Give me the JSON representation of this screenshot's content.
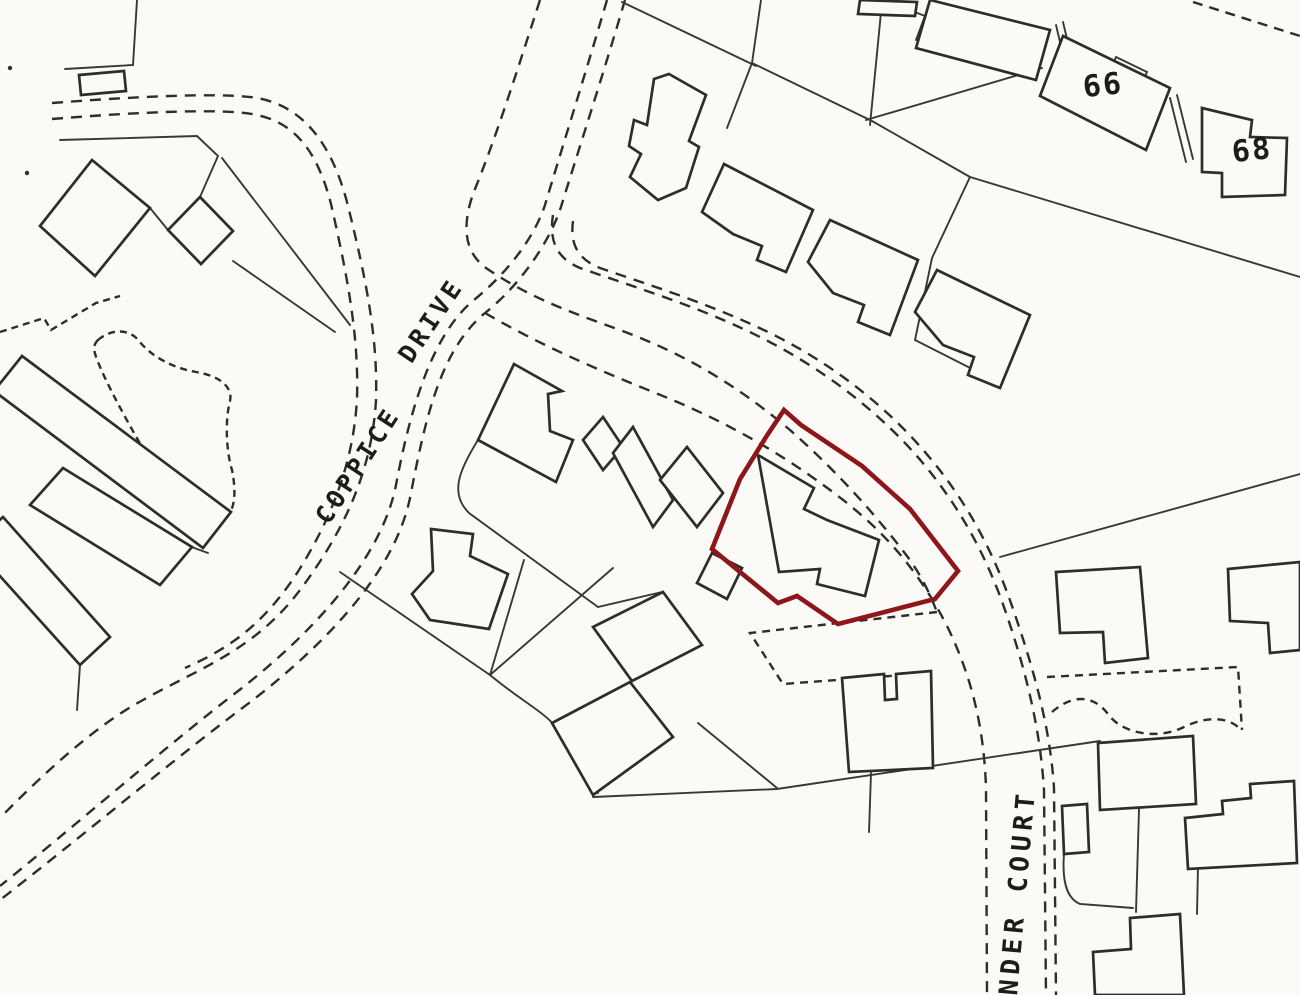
{
  "colors": {
    "paper": "#fbfaf7",
    "ink": "#2e2d29",
    "plot_ink": "#3a3833",
    "boundary_red": "#8d161a"
  },
  "map": {
    "labels": [
      {
        "text": "COPPICE",
        "x": 365,
        "y": 470,
        "rotate": -57,
        "size": 25,
        "spacing": 4
      },
      {
        "text": "DRIVE",
        "x": 438,
        "y": 325,
        "rotate": -56,
        "size": 25,
        "spacing": 4
      },
      {
        "text": "NDER COURT",
        "x": 1026,
        "y": 893,
        "rotate": -85,
        "size": 26,
        "spacing": 5
      },
      {
        "text": "66",
        "x": 1104,
        "y": 95,
        "rotate": -6,
        "size": 30,
        "spacing": 2
      },
      {
        "text": "68",
        "x": 1253,
        "y": 160,
        "rotate": -6,
        "size": 30,
        "spacing": 2
      }
    ],
    "red_boundary": {
      "name": "site-boundary",
      "points": "784,410 801,425 862,466 910,509 958,571 935,599 838,624 797,596 778,603 712,549 740,479 766,437",
      "color": "#8d161a",
      "width": 4.6
    },
    "buildings": [
      {
        "name": "outbuilding-top-left",
        "points": "79,75 124,71 126,91 81,95"
      },
      {
        "name": "house-pair-northwest",
        "points": "92,160 150,208 95,276 40,226"
      },
      {
        "name": "shed-diamond",
        "points": "200,197 233,231 201,264 168,230"
      },
      {
        "name": "terrace-west-a",
        "points": "22,356 231,512 203,548 -6,391"
      },
      {
        "name": "terrace-west-b",
        "points": "63,468 192,547 160,585 30,505"
      },
      {
        "name": "terrace-west-c",
        "points": "3,517 110,637 80,665 -28,545"
      },
      {
        "name": "house-coppice-east",
        "points": "514,364 562,391 548,394 550,431 573,440 556,482 478,440"
      },
      {
        "name": "house-middle-a",
        "points": "603,417 583,440 603,470 623,447"
      },
      {
        "name": "house-middle-b",
        "points": "633,427 613,453 653,527 673,500"
      },
      {
        "name": "house-middle-c",
        "points": "687,447 660,480 697,527 723,493"
      },
      {
        "name": "house-southwest",
        "points": "431,529 473,534 470,556 508,574 489,629 430,620 412,594 433,571"
      },
      {
        "name": "house-inside-site",
        "points": "758,455 814,488 804,509 827,520 879,540 865,596 817,584 820,569 779,572"
      },
      {
        "name": "garage-inside-site",
        "points": "712,553 742,568 727,599 697,583"
      },
      {
        "name": "square-house-north",
        "points": "593,627 663,592 702,645 632,681"
      },
      {
        "name": "square-house-south",
        "points": "552,723 630,682 673,737 593,795"
      },
      {
        "name": "house-top-row-1",
        "points": "669,74 706,95 689,141 699,147 686,188 658,200 630,177 641,154 629,146 634,120 647,125 654,79"
      },
      {
        "name": "house-top-row-2",
        "points": "724,164 813,210 786,272 757,260 762,246 733,234 702,212"
      },
      {
        "name": "house-top-row-3",
        "points": "830,220 918,260 890,335 858,322 864,305 833,293 808,262"
      },
      {
        "name": "house-top-row-4",
        "points": "937,270 1030,315 1000,388 968,375 974,357 943,345 915,312"
      },
      {
        "name": "house-66",
        "points": "1063,36 1170,88 1146,150 1040,96"
      },
      {
        "name": "house-68",
        "points": "1202,108 1252,120 1250,137 1287,138 1285,195 1222,197 1222,173 1202,172"
      },
      {
        "name": "house-top-edge-a",
        "points": "860,0 917,2 915,16 858,14"
      },
      {
        "name": "house-top-edge-b",
        "points": "930,0 1050,30 1036,80 916,48"
      },
      {
        "name": "house-east-l-shape",
        "points": "1056,572 1140,567 1148,658 1105,663 1103,632 1060,633"
      },
      {
        "name": "house-east-partial",
        "points": "1228,569 1300,562 1300,650 1270,653 1268,623 1230,621"
      },
      {
        "name": "house-court-l-shape",
        "points": "842,678 884,674 885,700 897,699 896,674 908,673 931,671 933,768 849,772"
      },
      {
        "name": "house-court-block",
        "points": "1098,743 1193,736 1196,804 1100,810"
      },
      {
        "name": "outbuilding-court",
        "points": "1062,806 1087,804 1089,852 1064,854"
      },
      {
        "name": "house-court-stepped",
        "points": "1185,818 1223,814 1222,801 1251,798 1250,784 1294,781 1297,863 1188,869"
      },
      {
        "name": "house-bottom-partial",
        "points": "1093,952 1131,949 1130,918 1180,914 1184,995 1095,995"
      }
    ],
    "plot_lines": [
      {
        "name": "wall-top-left",
        "d": "M137,0 L133,65 L65,69"
      },
      {
        "name": "fence-top-left",
        "d": "M60,140 L197,136 L218,156 L200,197"
      },
      {
        "name": "fence-link-shed",
        "d": "M168,230 L150,208"
      },
      {
        "name": "fence-to-road-a",
        "d": "M222,158 L350,325"
      },
      {
        "name": "fence-to-road-b",
        "d": "M233,261 L335,332"
      },
      {
        "name": "party-wall-nw",
        "d": "M117,186 L63,247"
      },
      {
        "name": "fence-top-center-a",
        "d": "M622,2 L756,66"
      },
      {
        "name": "fence-top-center-b",
        "d": "M761,0 L752,63"
      },
      {
        "name": "fence-top-center-c",
        "d": "M752,63 L727,128"
      },
      {
        "name": "fence-top-center-d",
        "d": "M752,63 L872,121 L970,177"
      },
      {
        "name": "fence-top-right-long",
        "d": "M970,177 L1300,277"
      },
      {
        "name": "fence-top-right-zig",
        "d": "M970,177 L932,258 L915,340 L980,373 L1020,330"
      },
      {
        "name": "fence-vertical-top",
        "d": "M882,2 L870,125"
      },
      {
        "name": "fence-to-66",
        "d": "M866,120 L1042,68"
      },
      {
        "name": "field-line-east",
        "d": "M1000,557 L1300,474"
      },
      {
        "name": "fence-mid-a",
        "d": "M340,572 L490,675"
      },
      {
        "name": "fence-mid-b",
        "d": "M524,560 L490,675"
      },
      {
        "name": "fence-mid-curve",
        "d": "M490,675 C520,700 543,711 557,728 C575,749 590,772 598,793"
      },
      {
        "name": "fence-mid-c",
        "d": "M490,675 L613,568"
      },
      {
        "name": "garden-corner-curve",
        "d": "M478,440 C458,472 450,494 469,513 L598,607"
      },
      {
        "name": "fence-mid-d",
        "d": "M598,607 L662,592"
      },
      {
        "name": "fence-bottom-long",
        "d": "M593,797 L777,789 L1100,741"
      },
      {
        "name": "fence-bottom-e",
        "d": "M698,723 L777,788"
      },
      {
        "name": "fence-court-vert-a",
        "d": "M1141,741 L1136,912"
      },
      {
        "name": "fence-court-vert-b",
        "d": "M871,773 L869,832"
      },
      {
        "name": "fence-court-vert-c",
        "d": "M1198,866 L1197,914"
      },
      {
        "name": "terrace-tail",
        "d": "M77,710 L80,665"
      },
      {
        "name": "terrace-notch",
        "d": "M186,545 L208,553"
      },
      {
        "name": "party-wall-66-a",
        "d": "M1056,25 L1072,93"
      },
      {
        "name": "party-wall-66-b",
        "d": "M1063,22 L1079,90"
      },
      {
        "name": "party-wall-68-a",
        "d": "M1170,98 L1186,162"
      },
      {
        "name": "party-wall-68-b",
        "d": "M1177,95 L1193,159"
      },
      {
        "name": "corner-top-right",
        "d": "M884,0 L925,16 L916,40"
      },
      {
        "name": "porch-66",
        "d": "M1116,57 L1147,72 L1142,84 L1111,69 Z"
      },
      {
        "name": "party-wall-court",
        "d": "M1145,739 L1148,806"
      },
      {
        "name": "garden-round-court",
        "d": "M1064,854 C1062,880 1066,898 1080,904 L1133,908"
      }
    ],
    "dashed_paths": [
      {
        "name": "road-coppice-west-outer",
        "dash": "11 8",
        "d": "M52,103 C155,95 228,93 257,98 C302,106 331,142 347,202 C366,278 378,338 376,400 C372,470 345,530 300,590 C255,650 200,668 143,700 C95,726 45,772 0,818"
      },
      {
        "name": "road-coppice-west-inner",
        "dash": "11 8",
        "d": "M52,119 C150,111 224,109 252,114 C294,121 317,150 331,204 C347,274 359,336 357,398 C354,458 334,514 299,570 C262,628 225,650 185,668"
      },
      {
        "name": "road-coppice-east-a",
        "dash": "11 8",
        "d": "M625,0 C602,78 578,152 560,210 C548,244 520,285 485,313 C440,350 425,420 410,498 C395,570 330,640 253,700 C175,758 80,838 0,900"
      },
      {
        "name": "road-coppice-east-b",
        "dash": "11 8",
        "d": "M607,0 C585,75 562,148 545,205 C534,238 508,272 474,300 C432,334 410,410 396,485 C382,556 318,628 242,688 C166,746 75,826 0,886"
      },
      {
        "name": "road-court-north-a",
        "dash": "11 8",
        "d": "M553,215 C549,240 556,258 580,268 C640,289 700,307 760,337 C820,367 878,410 922,462 C958,505 985,552 1005,610 C1025,668 1040,726 1044,790 L1046,995"
      },
      {
        "name": "road-court-north-b",
        "dash": "11 8",
        "d": "M573,221 C570,243 577,259 600,268 C658,288 716,306 774,335 C832,364 888,407 930,458 C965,500 992,548 1012,606 C1032,664 1050,724 1054,788 L1056,995"
      },
      {
        "name": "road-court-south",
        "dash": "11 8",
        "d": "M485,313 C540,345 598,370 658,394 C718,418 778,450 838,496 C888,534 922,576 948,628 C972,678 984,728 986,788 L987,995"
      },
      {
        "name": "site-verge-dashed",
        "dash": "11 8",
        "d": "M540,0 C518,68 496,138 473,194 C462,226 464,252 486,268 C530,298 570,312 620,330 C690,356 740,388 790,430 C840,474 880,520 910,560 C925,582 930,595 937,612"
      },
      {
        "name": "garden-quad-dashed",
        "dash": "8 6",
        "d": "M937,612 L750,633 L783,684 L930,673"
      },
      {
        "name": "plot-dashed-court-a",
        "dash": "8 6",
        "d": "M1047,677 L1238,667 L1242,730"
      },
      {
        "name": "plot-dashed-court-wavy",
        "dash": "8 6",
        "d": "M1052,712 C1075,692 1095,697 1108,714 C1122,734 1158,740 1184,727 C1204,717 1227,716 1239,728"
      },
      {
        "name": "dashed-top-right-corner",
        "dash": "10 7",
        "d": "M1193,2 L1300,36"
      },
      {
        "name": "dashed-zigzag-west",
        "dash": "7 5",
        "d": "M0,332 L44,318 L51,330 L96,303 L120,296"
      },
      {
        "name": "garden-loop-west",
        "dash": "7 5",
        "d": "M98,340 C112,328 130,329 139,341 C152,357 173,368 196,372 C220,376 233,387 230,401 C225,420 226,450 232,470 C236,490 235,506 229,514 C210,530 190,520 180,505 C165,485 150,462 138,440 C122,412 105,380 98,362 C94,352 92,346 98,340 Z"
      }
    ],
    "specks": [
      {
        "x": 10,
        "y": 68,
        "r": 2.2
      },
      {
        "x": 27,
        "y": 173,
        "r": 2.2
      }
    ]
  }
}
